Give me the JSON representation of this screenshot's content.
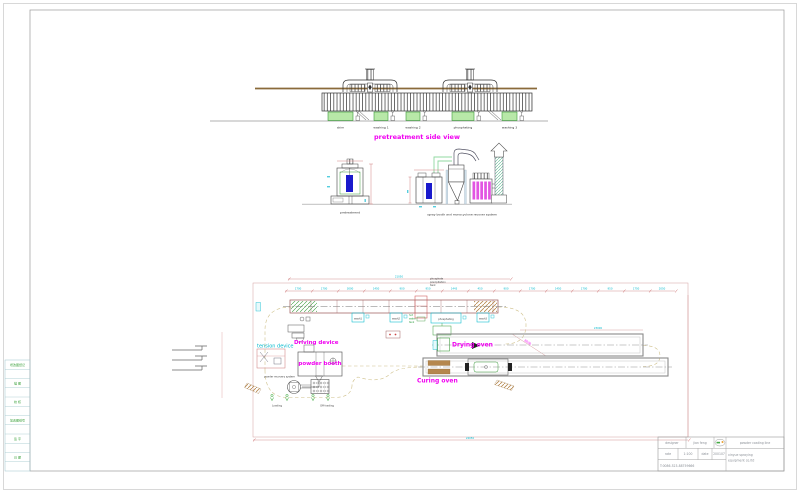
{
  "sheet": {
    "background": "#ffffff"
  },
  "colors": {
    "magenta_label": "#f000f0",
    "cyan_dim": "#00b8cc",
    "dim_red": "#cc8888",
    "tank_green_fill": "#b8e8a8",
    "tank_green_stroke": "#3a9a3a",
    "roof_olive": "#8a6a3a",
    "part_blue": "#1a1acc",
    "filter_magenta": "#e255e2",
    "burner_brown": "#b5874e"
  },
  "side_view": {
    "title": "pretreatment side view",
    "tank_labels": [
      "skim",
      "washing 1",
      "washing 2",
      "phosphating",
      "washing 3"
    ]
  },
  "sections": {
    "pretreatment_label": "pretreatment",
    "spray_label": "spray booth and monocyclone recover system"
  },
  "plan": {
    "precip_lines": [
      "phosphate",
      "precipitation",
      "tank"
    ],
    "hot_tank_lines": [
      "hot",
      "water",
      "tank"
    ],
    "wash1": "wash1",
    "wash2": "wash2",
    "wash3": "wash3",
    "phosphating": "phosphating",
    "driving_device": "Driving device",
    "tension_device": "tension device",
    "powder_booth": "powder booth",
    "powder_recovery": "powder recovery system",
    "drying_oven": "Drying oven",
    "curing_oven": "Curing oven",
    "loading": "Loading",
    "offloading": "Off-loading",
    "dims_top": [
      "1700",
      "1700",
      "3000",
      "1450",
      "900",
      "950",
      "1443",
      "450",
      "900",
      "1700",
      "1450",
      "1700",
      "950",
      "1750",
      "2050"
    ],
    "dim_overall_top": "21050",
    "dim_overall_bottom": "24050",
    "dim_oven": "23000",
    "dim_diag": "8000"
  },
  "revision_strip": {
    "rows": [
      "增改图纸记",
      "描 图",
      "校 核",
      "加改图纸号",
      "签 字",
      "日 期"
    ]
  },
  "title_block": {
    "designer_label": "designer",
    "designer_value": "jian feng",
    "rate_label": "rate",
    "rate_value": "1:100",
    "date_label": "date",
    "date_value": "200107",
    "phone": "T:0086-523-88759666",
    "product": "powder coating line",
    "company_line1": "xinyue spraying",
    "company_line2": "equipment co.ltd"
  }
}
